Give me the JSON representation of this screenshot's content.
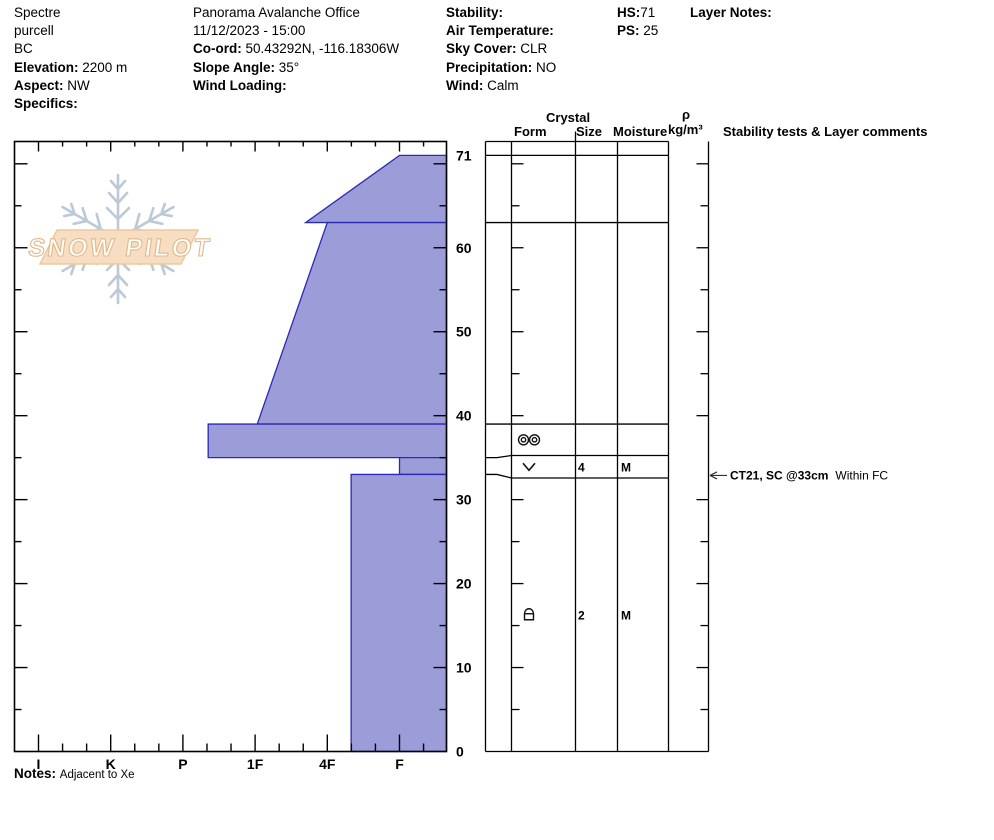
{
  "title_block": {
    "columns": [
      {
        "lines": [
          {
            "label": "",
            "value": "Spectre"
          },
          {
            "label": "",
            "value": "purcell"
          },
          {
            "label": "",
            "value": "BC"
          },
          {
            "label": "Elevation:",
            "value": "2200 m"
          },
          {
            "label": "Aspect:",
            "value": "NW"
          },
          {
            "label": "Specifics:",
            "value": ""
          }
        ]
      },
      {
        "lines": [
          {
            "label": "",
            "value": "Panorama Avalanche Office"
          },
          {
            "label": "",
            "value": "11/12/2023 - 15:00"
          },
          {
            "label": "Co-ord:",
            "value": "50.43292N, -116.18306W"
          },
          {
            "label": "Slope Angle:",
            "value": "35°"
          },
          {
            "label": "Wind Loading:",
            "value": ""
          }
        ]
      },
      {
        "lines": [
          {
            "label": "Stability:",
            "value": ""
          },
          {
            "label": "Air Temperature:",
            "value": ""
          },
          {
            "label": "Sky Cover:",
            "value": "CLR"
          },
          {
            "label": "Precipitation:",
            "value": "NO"
          },
          {
            "label": "Wind:",
            "value": "Calm"
          }
        ]
      },
      {
        "lines": [
          {
            "label": "HS:",
            "value": "71",
            "nospace": true
          },
          {
            "label": "PS:",
            "value": "25"
          }
        ]
      },
      {
        "lines": [
          {
            "label": "Layer Notes:",
            "value": ""
          }
        ]
      }
    ]
  },
  "logo": {
    "text": "SNOW PILOT"
  },
  "table": {
    "header_crystal": "Crystal",
    "header_form": "Form",
    "header_size": "Size",
    "header_moisture": "Moisture",
    "header_rho": "ρ",
    "header_rho_unit": "kg/m³",
    "header_comments": "Stability tests & Layer comments"
  },
  "notes": {
    "label": "Notes:",
    "text": "Adjacent to Xe"
  },
  "chart_data": {
    "type": "snow-profile-hardness-area",
    "title": "Snow pit hardness profile",
    "depth_axis": {
      "unit": "cm",
      "max": 71,
      "ticks_labeled": [
        71,
        60,
        50,
        40,
        30,
        20,
        10,
        0
      ],
      "minor_step_cm": 5
    },
    "hardness_axis": {
      "labels": [
        "I",
        "K",
        "P",
        "1F",
        "4F",
        "F"
      ],
      "values": [
        6,
        5,
        4,
        3,
        2,
        1
      ],
      "minors_per_interval": 2
    },
    "hs_cm": 71,
    "layers": [
      {
        "top_cm": 71,
        "bottom_cm": 63,
        "hardness_top": "F",
        "hardness_bottom": "4F+",
        "h_top": 1.0,
        "h_bot": 2.3,
        "form": "",
        "size": "",
        "moisture": ""
      },
      {
        "top_cm": 63,
        "bottom_cm": 39,
        "hardness_top": "4F",
        "hardness_bottom": "1F",
        "h_top": 2.0,
        "h_bot": 2.97,
        "form": "",
        "size": "",
        "moisture": ""
      },
      {
        "top_cm": 39,
        "bottom_cm": 35,
        "hardness_top": "P-",
        "hardness_bottom": "P-",
        "h_top": 3.65,
        "h_bot": 3.65,
        "form": "MF",
        "form_symbol": "two-circles",
        "size": "",
        "moisture": ""
      },
      {
        "top_cm": 35,
        "bottom_cm": 33,
        "hardness_top": "F",
        "hardness_bottom": "F",
        "h_top": 1.0,
        "h_bot": 1.0,
        "form": "SH",
        "form_symbol": "chevron-down",
        "size": "4",
        "moisture": "M"
      },
      {
        "top_cm": 33,
        "bottom_cm": 0,
        "hardness_top": "4F-",
        "hardness_bottom": "4F-",
        "h_top": 1.67,
        "h_bot": 1.67,
        "form": "FC",
        "form_symbol": "dome-square",
        "size": "2",
        "moisture": "M"
      }
    ],
    "annotation": {
      "text_bold": "CT21, SC @33cm",
      "text_plain": "Within FC",
      "depth_cm": 33
    },
    "legend_position": "none",
    "grid": false,
    "colors": {
      "layer_fill": "#9c9cd9",
      "layer_stroke": "#2a2ab4",
      "axis": "#000000",
      "logo_flake": "#bcc9d6",
      "logo_banner_fill": "#f7ddc1",
      "logo_banner_stroke": "#ecca9e",
      "logo_text_fill": "#fffdf8",
      "logo_text_stroke": "#e0b98e"
    }
  }
}
